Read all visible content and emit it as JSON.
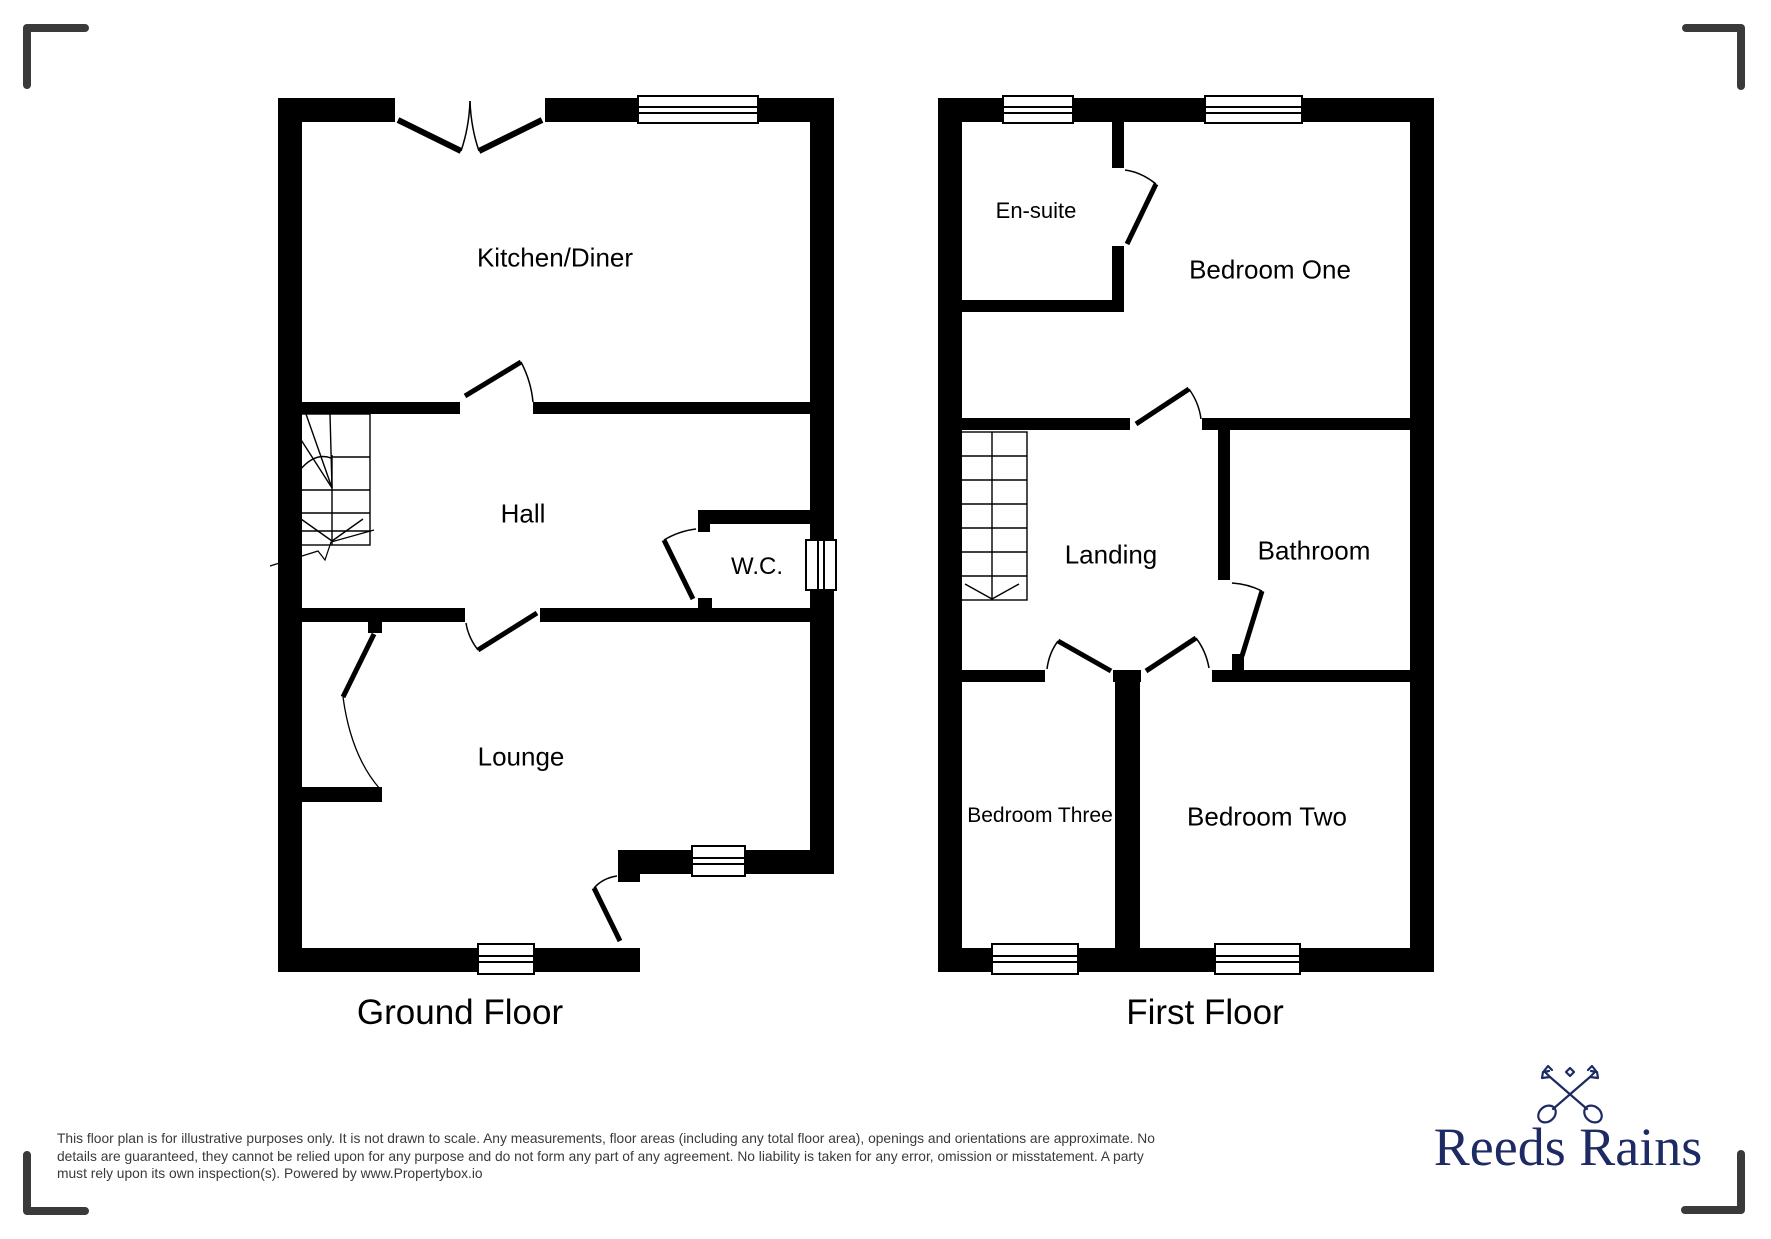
{
  "ground_floor": {
    "title": "Ground Floor",
    "rooms": {
      "kitchen_diner": "Kitchen/Diner",
      "hall": "Hall",
      "wc": "W.C.",
      "lounge": "Lounge"
    }
  },
  "first_floor": {
    "title": "First Floor",
    "rooms": {
      "en_suite": "En-suite",
      "bedroom_one": "Bedroom One",
      "landing": "Landing",
      "bathroom": "Bathroom",
      "bedroom_three": "Bedroom Three",
      "bedroom_two": "Bedroom Two"
    }
  },
  "disclaimer": {
    "lines": [
      "This floor plan is for illustrative purposes only. It is not drawn to scale. Any measurements, floor areas (including any total floor area), openings and orientations are approximate. No",
      "details are guaranteed, they cannot be relied upon for any purpose and do not form any part of any agreement. No liability is taken for any error, omission or misstatement. A party",
      "must rely upon its own inspection(s). Powered by www.Propertybox.io"
    ]
  },
  "branding": {
    "name": "Reeds Rains",
    "icon": "crossed-keys-icon",
    "color": "#1e2a63"
  },
  "colors": {
    "wall": "#000000",
    "frame_marks": "#3a3a3a",
    "disclaimer_text": "#3a3a3a"
  }
}
